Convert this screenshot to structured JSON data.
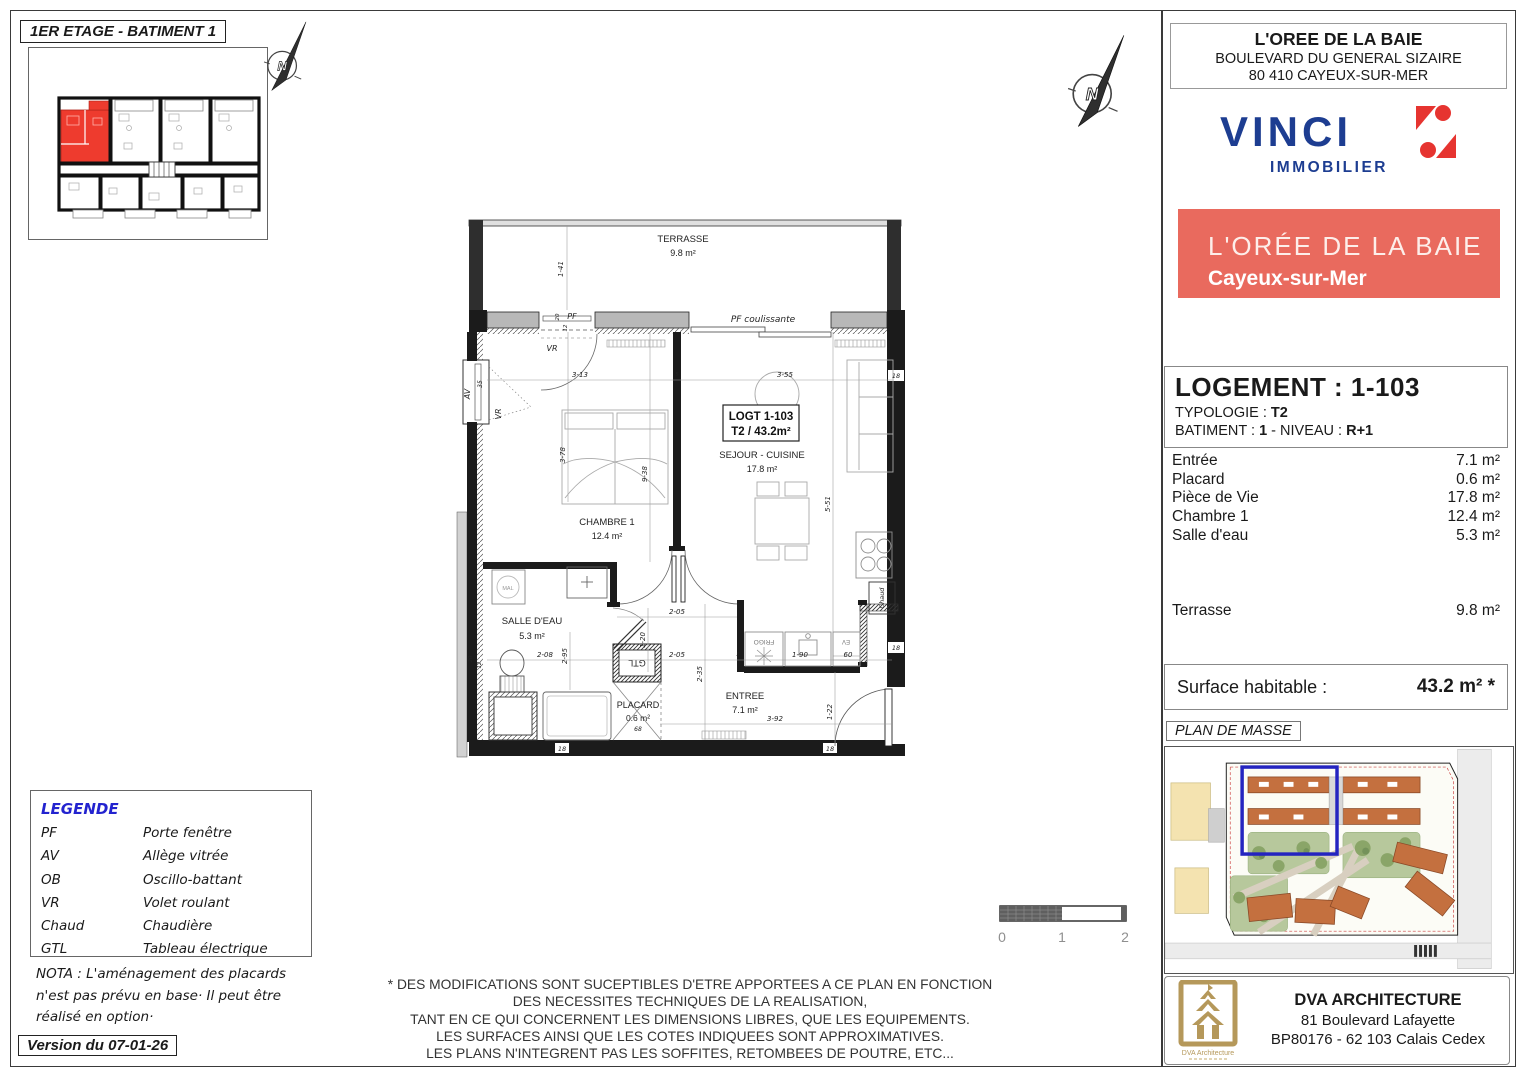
{
  "page": {
    "title": "1ER ETAGE - BATIMENT 1",
    "version": "Version du 07-01-26"
  },
  "compass": {
    "letter": "N"
  },
  "header": {
    "name": "L'OREE DE LA BAIE",
    "address1": "BOULEVARD DU GENERAL SIZAIRE",
    "address2": "80 410 CAYEUX-SUR-MER",
    "vinci_word": "VINCI",
    "vinci_sub": "IMMOBILIER",
    "banner_title": "L'ORÉE DE LA BAIE",
    "banner_city": "Cayeux-sur-Mer"
  },
  "logement": {
    "title": "LOGEMENT : 1-103",
    "typologie_label": "TYPOLOGIE : ",
    "typologie_value": "T2",
    "batiment_label": "BATIMENT : ",
    "batiment_value": "1",
    "niveau_label": " - NIVEAU : ",
    "niveau_value": "R+1",
    "rooms": [
      {
        "name": "Entrée",
        "area": "7.1 m²"
      },
      {
        "name": "Placard",
        "area": "0.6 m²"
      },
      {
        "name": "Pièce de Vie",
        "area": "17.8 m²"
      },
      {
        "name": "Chambre 1",
        "area": "12.4 m²"
      },
      {
        "name": "Salle d'eau",
        "area": "5.3 m²"
      }
    ],
    "terrasse_name": "Terrasse",
    "terrasse_area": "9.8 m²",
    "surface_label": "Surface habitable :",
    "surface_value": "43.2 m² *"
  },
  "masse_label": "PLAN DE MASSE",
  "architect": {
    "name": "DVA ARCHITECTURE",
    "address1": "81 Boulevard Lafayette",
    "address2": "BP80176 - 62 103 Calais Cedex",
    "logo_caption": "DVA Architecture"
  },
  "legend": {
    "title": "LEGENDE",
    "items": [
      {
        "abbr": "PF",
        "label": "Porte fenêtre"
      },
      {
        "abbr": "AV",
        "label": "Allège vitrée"
      },
      {
        "abbr": "OB",
        "label": "Oscillo-battant"
      },
      {
        "abbr": "VR",
        "label": "Volet roulant"
      },
      {
        "abbr": "Chaud",
        "label": "Chaudière"
      },
      {
        "abbr": "GTL",
        "label": "Tableau électrique"
      }
    ]
  },
  "nota": {
    "line1": "NOTA : L'aménagement des placards",
    "line2": "n'est pas prévu en base· Il peut être",
    "line3": "réalisé en option·"
  },
  "disclaimer": {
    "line1": "* DES MODIFICATIONS SONT SUCEPTIBLES D'ETRE APPORTEES A CE PLAN EN FONCTION",
    "line2": "DES NECESSITES TECHNIQUES DE LA REALISATION,",
    "line3": "TANT EN CE QUI CONCERNENT LES DIMENSIONS LIBRES, QUE LES EQUIPEMENTS.",
    "line4": "LES SURFACES AINSI QUE LES COTES INDIQUEES SONT APPROXIMATIVES.",
    "line5": "LES PLANS N'INTEGRENT PAS LES SOFFITES, RETOMBEES DE POUTRE, ETC..."
  },
  "scalebar": {
    "t0": "0",
    "t1": "1",
    "t2": "2"
  },
  "floorplan": {
    "unit_line1": "LOGT 1-103",
    "unit_line2": "T2 / 43.2m²",
    "rooms": {
      "terrasse": {
        "name": "TERRASSE",
        "area": "9.8 m²"
      },
      "chambre": {
        "name": "CHAMBRE 1",
        "area": "12.4 m²"
      },
      "sejour": {
        "name": "SEJOUR - CUISINE",
        "area": "17.8 m²"
      },
      "salledeau": {
        "name": "SALLE D'EAU",
        "area": "5.3 m²"
      },
      "entree": {
        "name": "ENTREE",
        "area": "7.1 m²"
      },
      "placard": {
        "name": "PLACARD",
        "area": "0.6 m²"
      }
    },
    "labels": {
      "pf": "PF",
      "pfc": "PF coulissante",
      "vr": "VR",
      "av": "AV",
      "gtl": "GTL",
      "mal": "MAL",
      "frigo": "FRIGO",
      "ev": "EV",
      "chaud": "Chaud"
    },
    "dims": {
      "d141": "1-41",
      "d313": "3-13",
      "d355": "3-55",
      "d378": "3-78",
      "d938": "9-38",
      "d551": "5-51",
      "d208": "2-08",
      "d295": "2-95",
      "d205": "2-05",
      "d235": "2-35",
      "d190": "1-90",
      "d60": "60",
      "d392": "3-92",
      "d122": "1-22",
      "d120": "1-20",
      "d68": "68",
      "d35": "35",
      "d18": "18",
      "d20": "20",
      "d12": "12",
      "d5": "5"
    }
  },
  "colors": {
    "banner": "#e96a5e",
    "vinci_blue": "#1d3d91",
    "vinci_red": "#e63430",
    "highlight_red": "#ee3b2e",
    "masse_blue": "#2424c0",
    "gold": "#b5985a",
    "legend_blue": "#2323cf"
  }
}
